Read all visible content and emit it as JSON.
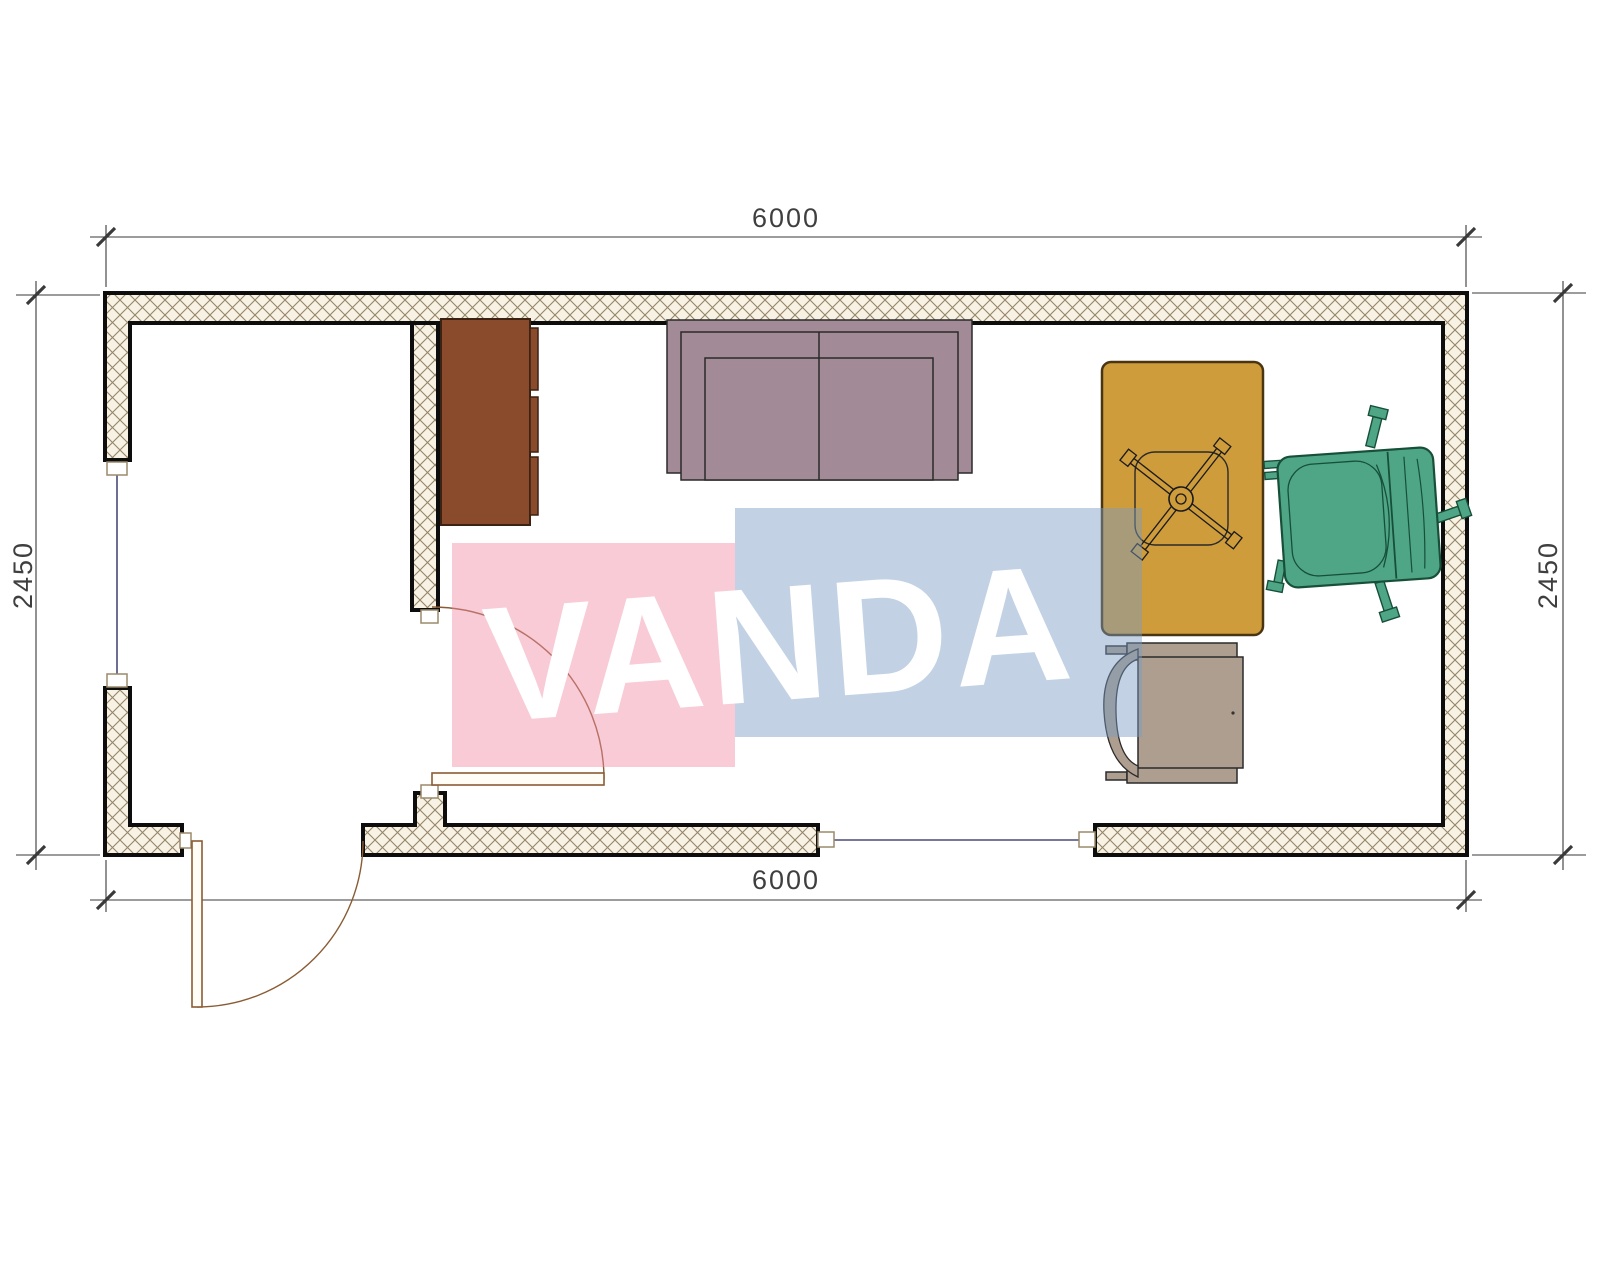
{
  "dimensions": {
    "top": "6000",
    "bottom": "6000",
    "left": "2450",
    "right": "2450"
  },
  "watermark": {
    "text": "VANDA",
    "pink_fill": "rgba(240,140,165,0.45)",
    "blue_fill": "rgba(120,155,195,0.45)",
    "text_color": "#ffffff"
  },
  "colors": {
    "wall_fill": "#f7f2e3",
    "wall_hatch": "#94846a",
    "wall_border": "#0d0d0d",
    "cabinet": "#8a4a2c",
    "sofa": "#a28a96",
    "table": "#cf9c3c",
    "chair_green": "#4ea687",
    "chair_tan": "#ae9e8f",
    "door": "#8a5c34",
    "window": "#4a4a7a",
    "dimension": "#3a3a3a"
  },
  "furniture": {
    "items": [
      "cabinet",
      "sofa",
      "table",
      "desk-chair-base",
      "office-chair-green",
      "armchair-tan"
    ]
  },
  "openings": {
    "items": [
      "entry-door",
      "interior-door",
      "window-left",
      "window-bottom"
    ]
  }
}
